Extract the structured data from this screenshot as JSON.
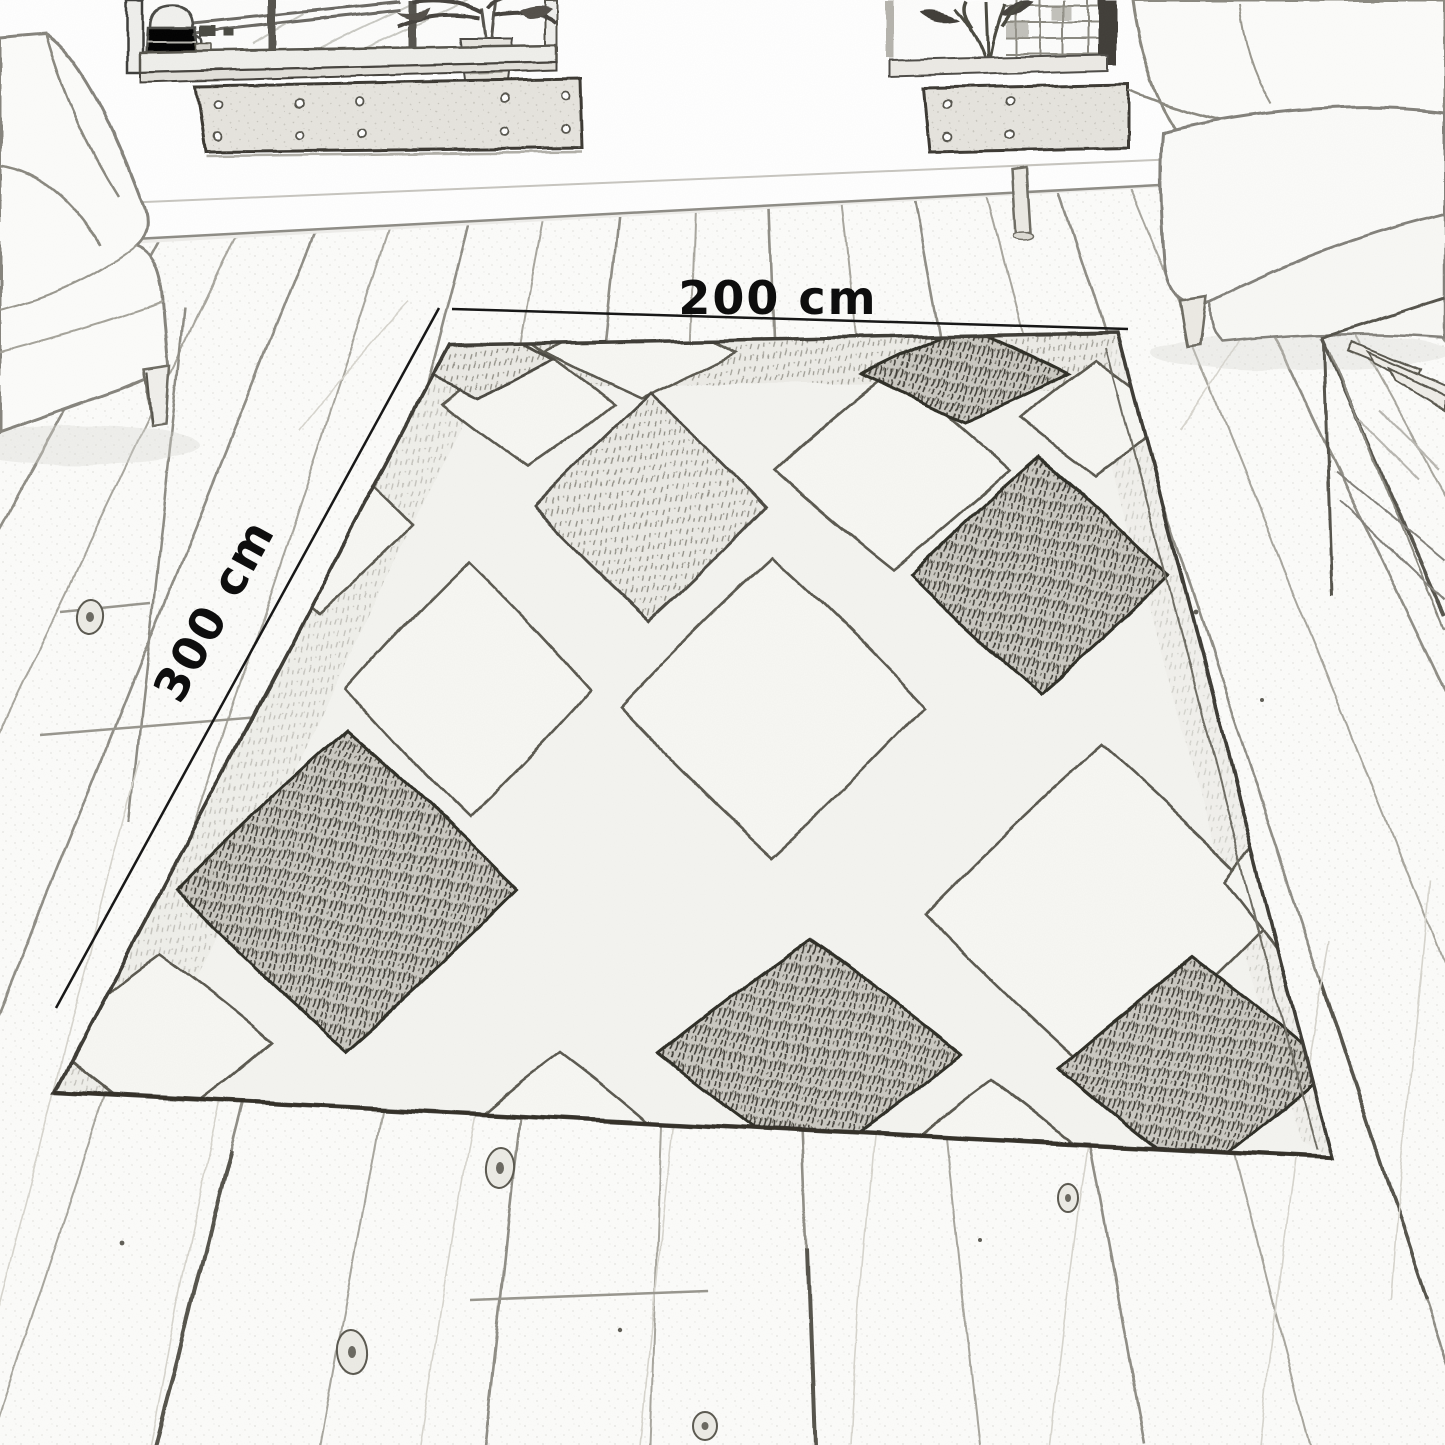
{
  "scene": {
    "type": "pencil-sketch room illustration",
    "objects": [
      "sofa",
      "window",
      "window-bench",
      "potted-plant",
      "milk-can",
      "armchair",
      "coffee-table",
      "area-rug",
      "wood-plank-floor",
      "dimension-lines"
    ]
  },
  "dimensions": {
    "width_label": "200 cm",
    "depth_label": "300 cm"
  },
  "colors": {
    "paper": "#ffffff",
    "ink": "#141414",
    "pencil_soft": "#8a8880",
    "rug_outline": "#3a3831",
    "rug_base": "#f4f4f0"
  }
}
